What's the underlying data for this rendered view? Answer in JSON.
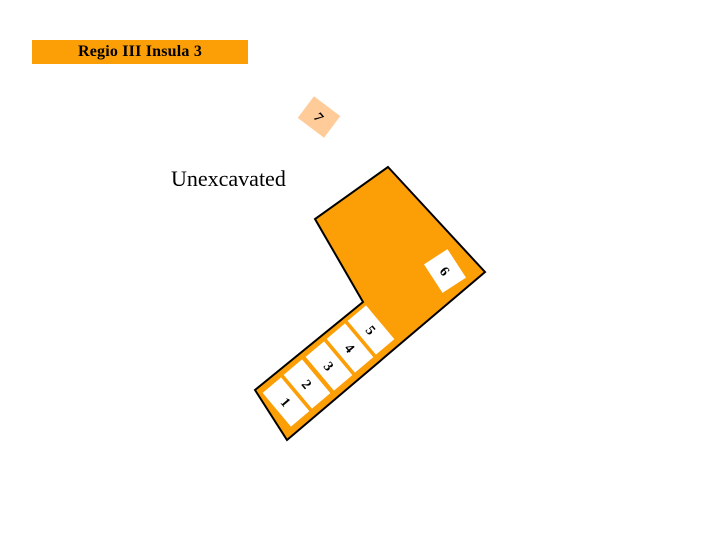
{
  "header": {
    "title": "Regio III Insula 3"
  },
  "map": {
    "unexcavated_label": "Unexcavated",
    "entrances": [
      {
        "number": "1"
      },
      {
        "number": "2"
      },
      {
        "number": "3"
      },
      {
        "number": "4"
      },
      {
        "number": "5"
      },
      {
        "number": "6"
      },
      {
        "number": "7"
      }
    ],
    "colors": {
      "insula_fill": "#FC9E06",
      "banner_bg": "#FC9E06",
      "entrance_fill": "#FFFFFF",
      "entrance7_fill": "#FFCC99",
      "outline": "#000000",
      "text": "#000000"
    }
  }
}
